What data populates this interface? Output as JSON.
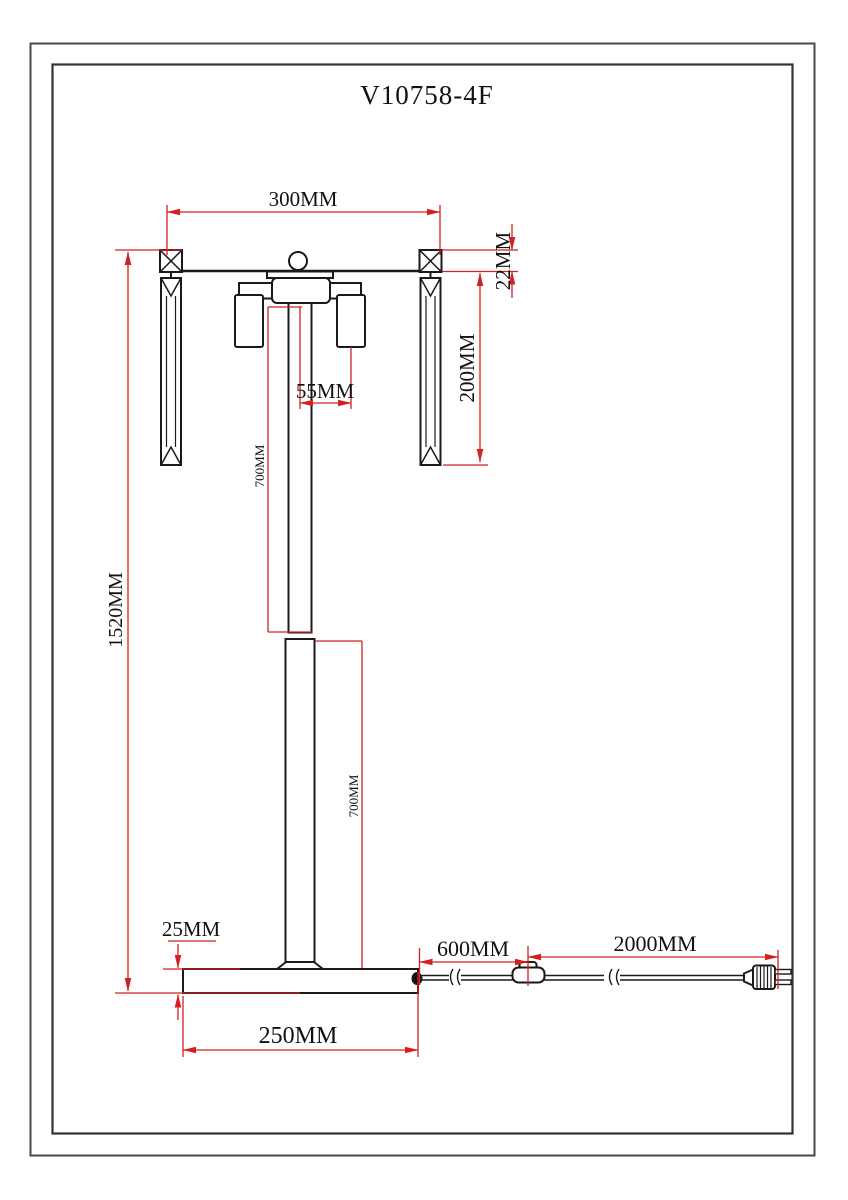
{
  "title": "V10758-4F",
  "colors": {
    "dimension_red": "#d42020",
    "outline_black": "#1a1a1a",
    "paper": "#ffffff"
  },
  "dimensions": {
    "arm_width": "300MM",
    "bar_thickness": "22MM",
    "crystal_length": "200MM",
    "shade_offset": "55MM",
    "upper_pole_length": "700MM",
    "lower_pole_length": "700MM",
    "total_height": "1520MM",
    "base_thickness": "25MM",
    "base_diameter": "250MM",
    "cord_base_to_switch": "600MM",
    "cord_switch_to_plug": "2000MM"
  }
}
